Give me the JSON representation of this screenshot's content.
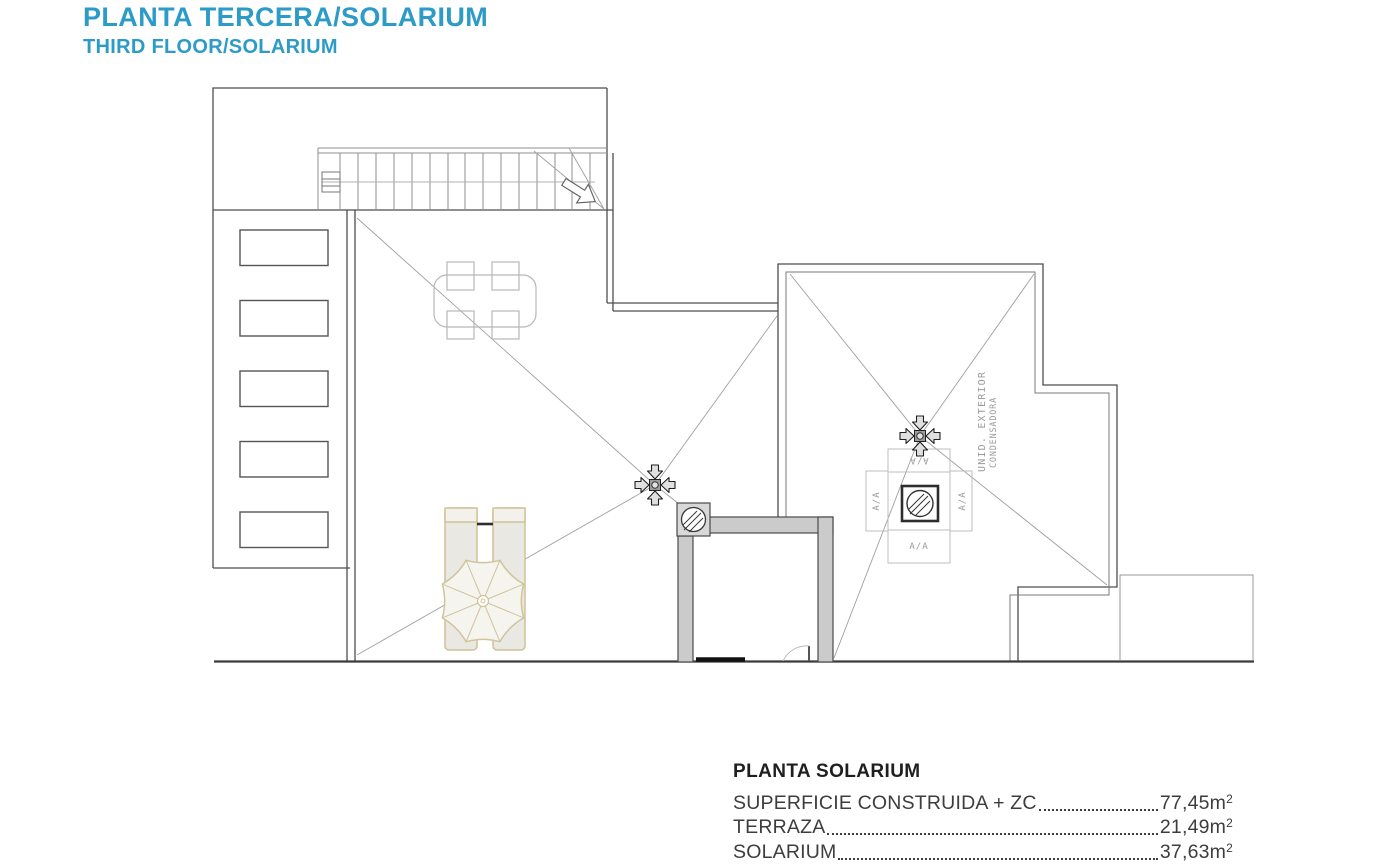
{
  "header": {
    "title_primary": "PLANTA TERCERA/SOLARIUM",
    "title_secondary": "THIRD FLOOR/SOLARIUM",
    "accent_color": "#2d9bc7"
  },
  "plan": {
    "labels": {
      "condenser_line1": "UNID. EXTERIOR",
      "condenser_line2": "CONDENSADORA",
      "ac_label": "A/A"
    }
  },
  "area_table": {
    "heading": "PLANTA SOLARIUM",
    "rows": [
      {
        "label": "SUPERFICIE CONSTRUIDA + ZC",
        "value": "77,45m",
        "sup": "2"
      },
      {
        "label": "TERRAZA",
        "value": "21,49m",
        "sup": "2"
      },
      {
        "label": "SOLARIUM",
        "value": "37,63m",
        "sup": "2"
      }
    ]
  }
}
